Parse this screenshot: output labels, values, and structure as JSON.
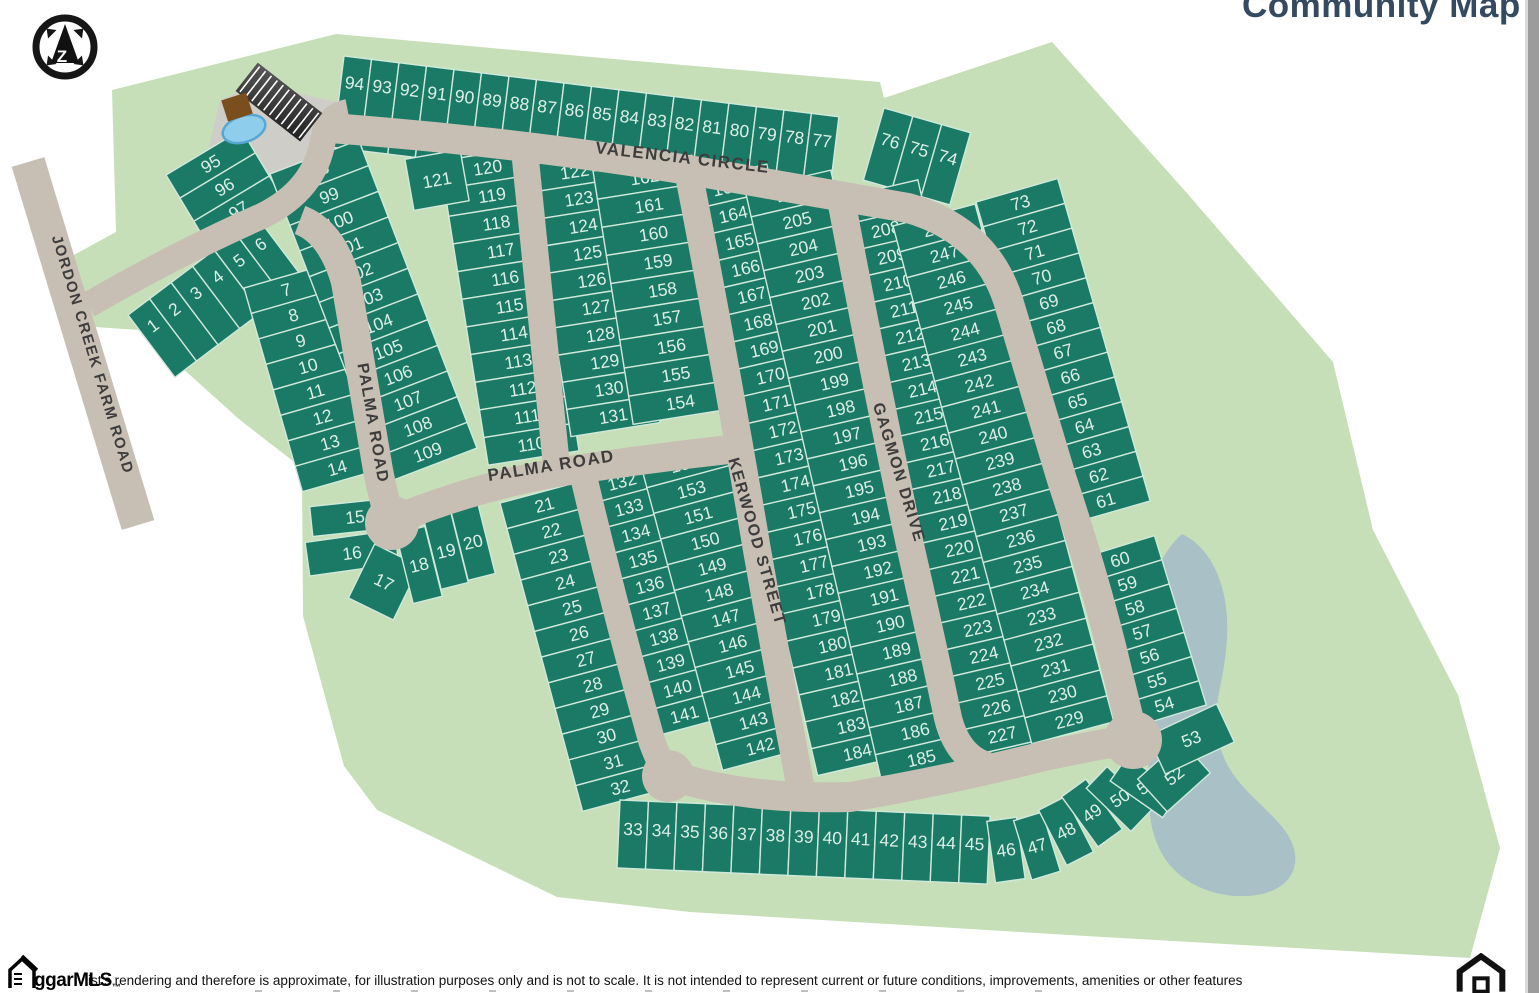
{
  "title": "Community Map",
  "compass": {
    "letter": "Z"
  },
  "footer": {
    "logo_text": "ggarMLS",
    "logo_tm": "™",
    "disclaimer": "ist's rendering and therefore is approximate, for illustration purposes only and is not to scale. It is not intended to represent current or future conditions, improvements, amenities or other features"
  },
  "colors": {
    "lot": "#1b7a66",
    "lot_line": "#cfe9db",
    "lot_text": "#dcefe5",
    "ground": "#c7dfb8",
    "road": "#c7bfb3",
    "road_text": "#3d3d3d",
    "pond": "#a9c0c6",
    "pool": "#8ecdec",
    "pool_edge": "#57a7d4",
    "building": "#7b4e1e",
    "parcel": "#cfcdc7",
    "title": "#344a60",
    "scrollbar": "#9c9c9c"
  },
  "map": {
    "streets": [
      {
        "name": "VALENCIA CIRCLE",
        "x": 682,
        "y": 163,
        "rot": 6.5,
        "size": 17
      },
      {
        "name": "PALMA ROAD",
        "x": 368,
        "y": 424,
        "rot": 80,
        "size": 16
      },
      {
        "name": "PALMA ROAD",
        "x": 552,
        "y": 471,
        "rot": -9,
        "size": 17
      },
      {
        "name": "KERWOOD STREET",
        "x": 752,
        "y": 543,
        "rot": 74,
        "size": 16
      },
      {
        "name": "GAGMON DRIVE",
        "x": 894,
        "y": 474,
        "rot": 73,
        "size": 16
      },
      {
        "name": "JORDON CREEK FARM ROAD",
        "x": 88,
        "y": 356,
        "rot": 73,
        "size": 15
      }
    ],
    "strips": [
      {
        "type": "row",
        "x": 344,
        "y": 56,
        "rot": 7,
        "w": 27.7,
        "h": 92,
        "ty": 0.28,
        "lots": [
          "94",
          "93",
          "92",
          "91",
          "90",
          "89",
          "88",
          "87",
          "86",
          "85",
          "84",
          "83",
          "82",
          "81",
          "80",
          "79",
          "78",
          "77"
        ]
      },
      {
        "type": "row",
        "x": 884,
        "y": 108,
        "rot": 16,
        "w": 30,
        "h": 75,
        "ty": 0.4,
        "lots": [
          "76",
          "75",
          "74"
        ]
      },
      {
        "type": "stack",
        "x": 166,
        "y": 175,
        "rot": -31,
        "w": 88,
        "h": 27,
        "lots": [
          "95",
          "96",
          "97"
        ]
      },
      {
        "type": "row",
        "x": 128,
        "y": 315,
        "rot": -37,
        "w": 27,
        "h": 78,
        "ty": 0.3,
        "lots": [
          "1",
          "2",
          "3",
          "4",
          "5",
          "6"
        ]
      },
      {
        "type": "stack",
        "x": 244,
        "y": 288,
        "rot": -16,
        "w": 80,
        "h": 26.5,
        "lots": [
          "7",
          "8",
          "9",
          "10",
          "11",
          "12",
          "13",
          "14"
        ]
      },
      {
        "type": "stack",
        "x": 270,
        "y": 174,
        "rot": -21,
        "w": 95,
        "h": 27.5,
        "lots": [
          "98",
          "99",
          "100",
          "101",
          "102",
          "103",
          "104",
          "105",
          "106",
          "107",
          "108",
          "109"
        ]
      },
      {
        "type": "stack",
        "x": 440,
        "y": 161,
        "rot": -9,
        "w": 92,
        "h": 28,
        "lots": [
          "120",
          "119",
          "118",
          "117",
          "116",
          "115",
          "114",
          "113",
          "112",
          "111",
          "110"
        ]
      },
      {
        "type": "stack",
        "x": 528,
        "y": 165,
        "rot": -9,
        "w": 90,
        "h": 27.5,
        "lots": [
          "122",
          "123",
          "124",
          "125",
          "126",
          "127",
          "128",
          "129",
          "130",
          "131"
        ]
      },
      {
        "type": "stack",
        "x": 593,
        "y": 171,
        "rot": -9,
        "w": 100,
        "h": 28.5,
        "lots": [
          "162",
          "161",
          "160",
          "159",
          "158",
          "157",
          "156",
          "155",
          "154"
        ]
      },
      {
        "type": "stack",
        "x": 576,
        "y": 480,
        "rot": -15,
        "w": 88,
        "h": 26.8,
        "lots": [
          "132",
          "133",
          "134",
          "135",
          "136",
          "137",
          "138",
          "139",
          "140",
          "141"
        ]
      },
      {
        "type": "stack",
        "x": 640,
        "y": 462,
        "rot": -15,
        "w": 85,
        "h": 26.6,
        "lots": [
          "153",
          "153",
          "151",
          "150",
          "149",
          "148",
          "147",
          "146",
          "145",
          "144",
          "143",
          "142"
        ]
      },
      {
        "type": "stack",
        "x": 500,
        "y": 503,
        "rot": -15,
        "w": 85,
        "h": 26.6,
        "lots": [
          "21",
          "22",
          "23",
          "24",
          "25",
          "26",
          "27",
          "28",
          "29",
          "30",
          "31",
          "32"
        ]
      },
      {
        "type": "stack",
        "x": 681,
        "y": 184,
        "rot": -13,
        "w": 88,
        "h": 27.6,
        "lots": [
          "163",
          "164",
          "165",
          "166",
          "167",
          "168",
          "169",
          "170",
          "171",
          "172",
          "173",
          "174",
          "175",
          "176",
          "177",
          "178",
          "179",
          "180",
          "181",
          "182",
          "183",
          "184"
        ]
      },
      {
        "type": "stack",
        "x": 745,
        "y": 190,
        "rot": -13,
        "w": 88,
        "h": 27.6,
        "lots": [
          "206",
          "205",
          "204",
          "203",
          "202",
          "201",
          "200",
          "199",
          "198",
          "197",
          "196",
          "195",
          "194",
          "193",
          "192",
          "191",
          "190",
          "189",
          "188",
          "187",
          "186",
          "185"
        ]
      },
      {
        "type": "stack",
        "x": 835,
        "y": 199,
        "rot": -13,
        "w": 85,
        "h": 27.3,
        "lots": [
          "207",
          "208",
          "209",
          "210",
          "211",
          "212",
          "213",
          "214",
          "215",
          "216",
          "217",
          "218",
          "219",
          "220",
          "221",
          "222",
          "223",
          "224",
          "225",
          "226",
          "227",
          "228"
        ]
      },
      {
        "type": "stack",
        "x": 893,
        "y": 226,
        "rot": -15,
        "w": 85,
        "h": 26.8,
        "lots": [
          "248",
          "247",
          "246",
          "245",
          "244",
          "243",
          "242",
          "241",
          "240",
          "239",
          "238",
          "237",
          "236",
          "235",
          "234",
          "233",
          "232",
          "231",
          "230",
          "229"
        ]
      },
      {
        "type": "stack",
        "x": 976,
        "y": 202,
        "rot": -16,
        "w": 85,
        "h": 25.8,
        "lots": [
          "73",
          "72",
          "71",
          "70",
          "69",
          "68",
          "67",
          "66",
          "65",
          "64",
          "63",
          "62",
          "61"
        ]
      },
      {
        "type": "stack",
        "x": 1078,
        "y": 559,
        "rot": -17,
        "w": 80,
        "h": 25.3,
        "lots": [
          "60",
          "59",
          "58",
          "57",
          "56",
          "55",
          "54"
        ]
      },
      {
        "type": "row",
        "x": 620,
        "y": 800,
        "rot": 2.5,
        "w": 28.5,
        "h": 68,
        "ty": 0.42,
        "lots": [
          "33",
          "34",
          "35",
          "36",
          "37",
          "38",
          "39",
          "40",
          "41",
          "42",
          "43",
          "44",
          "45"
        ]
      }
    ],
    "free_lots": [
      {
        "n": "121",
        "x": 437,
        "y": 180,
        "r": -10,
        "w": 56,
        "h": 52
      },
      {
        "n": "15",
        "x": 355,
        "y": 517,
        "r": -6,
        "w": 88,
        "h": 30
      },
      {
        "n": "16",
        "x": 352,
        "y": 553,
        "r": -8,
        "w": 90,
        "h": 34
      },
      {
        "n": "17",
        "x": 384,
        "y": 582,
        "r": 26,
        "w": 50,
        "h": 60
      },
      {
        "n": "18",
        "x": 419,
        "y": 565,
        "r": -14,
        "w": 30,
        "h": 72
      },
      {
        "n": "19",
        "x": 446,
        "y": 551,
        "r": -14,
        "w": 28,
        "h": 72
      },
      {
        "n": "20",
        "x": 473,
        "y": 542,
        "r": -14,
        "w": 28,
        "h": 72
      },
      {
        "n": "46",
        "x": 1006,
        "y": 850,
        "r": -8,
        "w": 30,
        "h": 62
      },
      {
        "n": "47",
        "x": 1037,
        "y": 846,
        "r": -17,
        "w": 30,
        "h": 62
      },
      {
        "n": "48",
        "x": 1066,
        "y": 831,
        "r": -27,
        "w": 30,
        "h": 62
      },
      {
        "n": "49",
        "x": 1092,
        "y": 813,
        "r": -36,
        "w": 30,
        "h": 62
      },
      {
        "n": "50",
        "x": 1119,
        "y": 799,
        "r": -46,
        "w": 30,
        "h": 62,
        "tr": -34
      },
      {
        "n": "51",
        "x": 1145,
        "y": 787,
        "r": -55,
        "w": 30,
        "h": 64,
        "tr": -34
      },
      {
        "n": "52",
        "x": 1174,
        "y": 776,
        "r": -42,
        "w": 58,
        "h": 44,
        "tr": -38
      },
      {
        "n": "53",
        "x": 1191,
        "y": 739,
        "r": -25,
        "w": 76,
        "h": 42,
        "tr": -22
      }
    ]
  }
}
